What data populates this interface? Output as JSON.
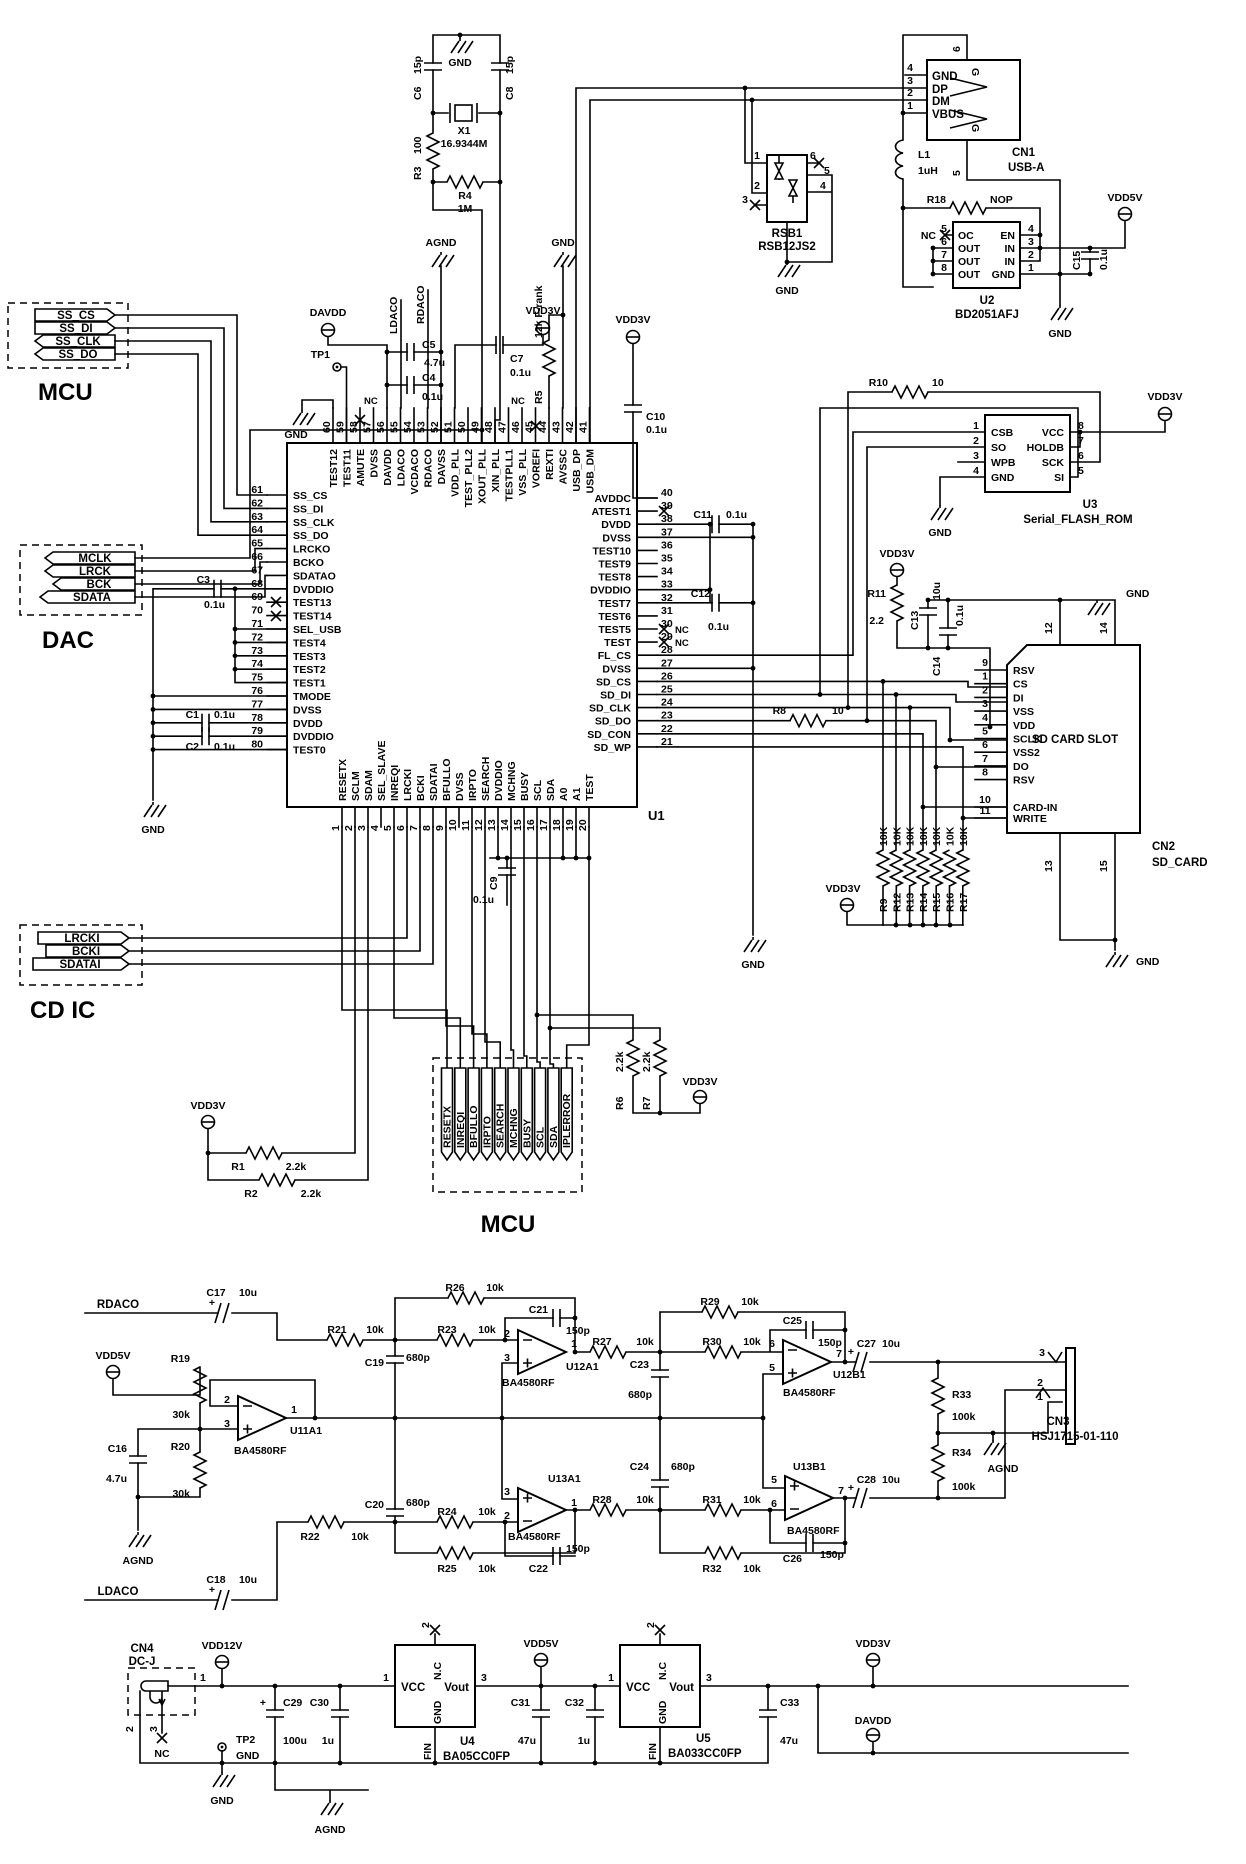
{
  "labels": {
    "gnd": "GND",
    "agnd": "AGND",
    "nc": "NC",
    "vdd3v": "VDD3V",
    "vdd5v": "VDD5V",
    "vdd12v": "VDD12V",
    "davdd": "DAVDD",
    "tp1": "TP1",
    "tp2": "TP2",
    "plus": "+"
  },
  "x1": {
    "ref": "X1",
    "v": "16.9344M"
  },
  "l1": {
    "ref": "L1",
    "v": "1uH"
  },
  "r": {
    "r1": {
      "ref": "R1",
      "v": "2.2k"
    },
    "r2": {
      "ref": "R2",
      "v": "2.2k"
    },
    "r3": {
      "ref": "R3",
      "v": "100"
    },
    "r4": {
      "ref": "R4",
      "v": "1M"
    },
    "r5": {
      "ref": "R5",
      "v": "12k F-rank"
    },
    "r6": {
      "ref": "R6",
      "v": "2.2k"
    },
    "r7": {
      "ref": "R7",
      "v": "2.2k"
    },
    "r8": {
      "ref": "R8",
      "v": "10"
    },
    "r10": {
      "ref": "R10",
      "v": "10"
    },
    "r11": {
      "ref": "R11",
      "v": "2.2"
    },
    "r18": {
      "ref": "R18",
      "v": "NOP"
    },
    "r19": {
      "ref": "R19",
      "v": "30k"
    },
    "r20": {
      "ref": "R20",
      "v": "30k"
    },
    "r21": {
      "ref": "R21",
      "v": "10k"
    },
    "r22": {
      "ref": "R22",
      "v": "10k"
    },
    "r23": {
      "ref": "R23",
      "v": "10k"
    },
    "r24": {
      "ref": "R24",
      "v": "10k"
    },
    "r25": {
      "ref": "R25",
      "v": "10k"
    },
    "r26": {
      "ref": "R26",
      "v": "10k"
    },
    "r27": {
      "ref": "R27",
      "v": "10k"
    },
    "r28": {
      "ref": "R28",
      "v": "10k"
    },
    "r29": {
      "ref": "R29",
      "v": "10k"
    },
    "r30": {
      "ref": "R30",
      "v": "10k"
    },
    "r31": {
      "ref": "R31",
      "v": "10k"
    },
    "r32": {
      "ref": "R32",
      "v": "10k"
    },
    "r33": {
      "ref": "R33",
      "v": "100k"
    },
    "r34": {
      "ref": "R34",
      "v": "100k"
    }
  },
  "c": {
    "c1": {
      "ref": "C1",
      "v": "0.1u"
    },
    "c2": {
      "ref": "C2",
      "v": "0.1u"
    },
    "c3": {
      "ref": "C3",
      "v": "0.1u"
    },
    "c4": {
      "ref": "C4",
      "v": "0.1u"
    },
    "c5": {
      "ref": "C5",
      "v": "4.7u"
    },
    "c6": {
      "ref": "C6",
      "v": "15p"
    },
    "c7": {
      "ref": "C7",
      "v": "0.1u"
    },
    "c8": {
      "ref": "C8",
      "v": "15p"
    },
    "c9": {
      "ref": "C9",
      "v": "0.1u"
    },
    "c10": {
      "ref": "C10",
      "v": "0.1u"
    },
    "c11": {
      "ref": "C11",
      "v": "0.1u"
    },
    "c12": {
      "ref": "C12",
      "v": "0.1u"
    },
    "c13": {
      "ref": "C13",
      "v": "10u"
    },
    "c14": {
      "ref": "C14",
      "v": "0.1u"
    },
    "c15": {
      "ref": "C15",
      "v": "0.1u"
    },
    "c16": {
      "ref": "C16",
      "v": "4.7u"
    },
    "c17": {
      "ref": "C17",
      "v": "10u"
    },
    "c18": {
      "ref": "C18",
      "v": "10u"
    },
    "c19": {
      "ref": "C19",
      "v": "680p"
    },
    "c20": {
      "ref": "C20",
      "v": "680p"
    },
    "c21": {
      "ref": "C21",
      "v": "150p"
    },
    "c22": {
      "ref": "C22",
      "v": "150p"
    },
    "c23": {
      "ref": "C23",
      "v": "680p"
    },
    "c24": {
      "ref": "C24",
      "v": "680p"
    },
    "c25": {
      "ref": "C25",
      "v": "150p"
    },
    "c26": {
      "ref": "C26",
      "v": "150p"
    },
    "c27": {
      "ref": "C27",
      "v": "10u"
    },
    "c28": {
      "ref": "C28",
      "v": "10u"
    },
    "c29": {
      "ref": "C29",
      "v": "100u"
    },
    "c30": {
      "ref": "C30",
      "v": "1u"
    },
    "c31": {
      "ref": "C31",
      "v": "47u"
    },
    "c32": {
      "ref": "C32",
      "v": "1u"
    },
    "c33": {
      "ref": "C33",
      "v": "47u"
    }
  },
  "u1": {
    "ref": "U1",
    "top": [
      [
        "60",
        "TEST12"
      ],
      [
        "59",
        "TEST11"
      ],
      [
        "58",
        "AMUTE"
      ],
      [
        "57",
        "DVSS"
      ],
      [
        "56",
        "DAVDD"
      ],
      [
        "55",
        "LDACO"
      ],
      [
        "54",
        "VCDACO"
      ],
      [
        "53",
        "RDACO"
      ],
      [
        "52",
        "DAVSS"
      ],
      [
        "51",
        "VDD_PLL"
      ],
      [
        "50",
        "TEST_PLL2"
      ],
      [
        "49",
        "XOUT_PLL"
      ],
      [
        "48",
        "XIN_PLL"
      ],
      [
        "47",
        "TESTPLL1"
      ],
      [
        "46",
        "VSS_PLL"
      ],
      [
        "45",
        "VOREFI"
      ],
      [
        "44",
        "REXTI"
      ],
      [
        "43",
        "AVSSC"
      ],
      [
        "42",
        "USB_DP"
      ],
      [
        "41",
        "USB_DM"
      ]
    ],
    "left": [
      [
        "61",
        "SS_CS"
      ],
      [
        "62",
        "SS_DI"
      ],
      [
        "63",
        "SS_CLK"
      ],
      [
        "64",
        "SS_DO"
      ],
      [
        "65",
        "LRCKO"
      ],
      [
        "66",
        "BCKO"
      ],
      [
        "67",
        "SDATAO"
      ],
      [
        "68",
        "DVDDIO"
      ],
      [
        "69",
        "TEST13"
      ],
      [
        "70",
        "TEST14"
      ],
      [
        "71",
        "SEL_USB"
      ],
      [
        "72",
        "TEST4"
      ],
      [
        "73",
        "TEST3"
      ],
      [
        "74",
        "TEST2"
      ],
      [
        "75",
        "TEST1"
      ],
      [
        "76",
        "TMODE"
      ],
      [
        "77",
        "DVSS"
      ],
      [
        "78",
        "DVDD"
      ],
      [
        "79",
        "DVDDIO"
      ],
      [
        "80",
        "TEST0"
      ]
    ],
    "right": [
      [
        "40",
        "AVDDC"
      ],
      [
        "39",
        "ATEST1"
      ],
      [
        "38",
        "DVDD"
      ],
      [
        "37",
        "DVSS"
      ],
      [
        "36",
        "TEST10"
      ],
      [
        "35",
        "TEST9"
      ],
      [
        "34",
        "TEST8"
      ],
      [
        "33",
        "DVDDIO"
      ],
      [
        "32",
        "TEST7"
      ],
      [
        "31",
        "TEST6"
      ],
      [
        "30",
        "TEST5"
      ],
      [
        "29",
        "TEST"
      ],
      [
        "28",
        "FL_CS"
      ],
      [
        "27",
        "DVSS"
      ],
      [
        "26",
        "SD_CS"
      ],
      [
        "25",
        "SD_DI"
      ],
      [
        "24",
        "SD_CLK"
      ],
      [
        "23",
        "SD_DO"
      ],
      [
        "22",
        "SD_CON"
      ],
      [
        "21",
        "SD_WP"
      ]
    ],
    "bottom": [
      [
        "1",
        "RESETX"
      ],
      [
        "2",
        "SCLM"
      ],
      [
        "3",
        "SDAM"
      ],
      [
        "4",
        "SEL_SLAVE"
      ],
      [
        "5",
        "INREQI"
      ],
      [
        "6",
        "LRCKI"
      ],
      [
        "7",
        "BCKI"
      ],
      [
        "8",
        "SDATAI"
      ],
      [
        "9",
        "BFULLO"
      ],
      [
        "10",
        "DVSS"
      ],
      [
        "11",
        "IRPTO"
      ],
      [
        "12",
        "SEARCH"
      ],
      [
        "13",
        "DVDDIO"
      ],
      [
        "14",
        "MCHNG"
      ],
      [
        "15",
        "BUSY"
      ],
      [
        "16",
        "SCL"
      ],
      [
        "17",
        "SDA"
      ],
      [
        "18",
        "A0"
      ],
      [
        "19",
        "A1"
      ],
      [
        "20",
        "TEST"
      ]
    ],
    "netlabels": {
      "ldaco": "LDACO",
      "rdaco": "RDACO"
    }
  },
  "cn1": {
    "ref": "CN1",
    "part": "USB-A",
    "p4": "4",
    "gnd": "GND",
    "p3": "3",
    "dp": "DP",
    "p2": "2",
    "dm": "DM",
    "p1": "1",
    "vbus": "VBUS",
    "p6": "6",
    "p5": "5",
    "g": "G"
  },
  "rsb1": {
    "ref": "RSB1",
    "part": "RSB12JS2",
    "p1": "1",
    "p2": "2",
    "p3": "3",
    "p4": "4",
    "p5": "5",
    "p6": "6"
  },
  "u2": {
    "ref": "U2",
    "part": "BD2051AFJ",
    "l": [
      [
        "5",
        "OC"
      ],
      [
        "6",
        "OUT"
      ],
      [
        "7",
        "OUT"
      ],
      [
        "8",
        "OUT"
      ]
    ],
    "rt": [
      [
        "4",
        "EN"
      ],
      [
        "3",
        "IN"
      ],
      [
        "2",
        "IN"
      ],
      [
        "1",
        "GND"
      ]
    ]
  },
  "u3": {
    "ref": "U3",
    "part": "Serial_FLASH_ROM",
    "l": [
      [
        "1",
        "CSB"
      ],
      [
        "2",
        "SO"
      ],
      [
        "3",
        "WPB"
      ],
      [
        "4",
        "GND"
      ]
    ],
    "rt": [
      [
        "8",
        "VCC"
      ],
      [
        "7",
        "HOLDB"
      ],
      [
        "6",
        "SCK"
      ],
      [
        "5",
        "SI"
      ]
    ]
  },
  "cn2": {
    "ref": "CN2",
    "part": "SD_CARD",
    "title": "SD CARD SLOT",
    "pins": [
      [
        "9",
        "RSV"
      ],
      [
        "1",
        "CS"
      ],
      [
        "2",
        "DI"
      ],
      [
        "3",
        "VSS"
      ],
      [
        "4",
        "VDD"
      ],
      [
        "5",
        "SCLK"
      ],
      [
        "6",
        "VSS2"
      ],
      [
        "7",
        "DO"
      ],
      [
        "8",
        "RSV"
      ]
    ],
    "pins2": [
      [
        "10",
        "CARD-IN"
      ],
      [
        "11",
        "WRITE"
      ]
    ],
    "t12": "12",
    "t14": "14",
    "b13": "13",
    "b15": "15"
  },
  "sd": {
    "pullups": [
      [
        "R9",
        "10K"
      ],
      [
        "R12",
        "10K"
      ],
      [
        "R13",
        "10K"
      ],
      [
        "R14",
        "10K"
      ],
      [
        "R15",
        "10K"
      ],
      [
        "R16",
        "10K"
      ],
      [
        "R17",
        "10K"
      ]
    ]
  },
  "conn": {
    "mcu_top": {
      "label": "MCU",
      "tags": [
        "SS_CS",
        "SS_DI",
        "SS_CLK",
        "SS_DO"
      ]
    },
    "dac": {
      "label": "DAC",
      "tags": [
        "MCLK",
        "LRCK",
        "BCK",
        "SDATA"
      ]
    },
    "cdic": {
      "label": "CD IC",
      "tags": [
        "LRCKI",
        "BCKI",
        "SDATAI"
      ]
    },
    "mcu_bottom": {
      "label": "MCU",
      "tags": [
        "RESETX",
        "INREQI",
        "BFULLO",
        "IRPTO",
        "SEARCH",
        "MCHNG",
        "BUSY",
        "SCL",
        "SDA",
        "IPLERROR"
      ]
    }
  },
  "opamps": {
    "u11a1": {
      "ref": "U11A1",
      "part": "BA4580RF",
      "p1": "2",
      "p2": "3",
      "po": "1"
    },
    "u12a1": {
      "ref": "U12A1",
      "part": "BA4580RF",
      "p1": "2",
      "p2": "3",
      "po": "1"
    },
    "u12b1": {
      "ref": "U12B1",
      "part": "BA4580RF",
      "p1": "6",
      "p2": "5",
      "po": "7"
    },
    "u13a1": {
      "ref": "U13A1",
      "part": "BA4580RF",
      "p1": "3",
      "p2": "2",
      "po": "1"
    },
    "u13b1": {
      "ref": "U13B1",
      "part": "BA4580RF",
      "p1": "5",
      "p2": "6",
      "po": "7"
    }
  },
  "audio": {
    "rdaco": "RDACO",
    "ldaco": "LDACO"
  },
  "cn3": {
    "ref": "CN3",
    "part": "HSJ1715-01-110",
    "p3": "3",
    "p2": "2",
    "p1": "1"
  },
  "cn4": {
    "ref": "CN4",
    "part": "DC-J",
    "p1": "1",
    "p2": "2",
    "p3": "3"
  },
  "u4": {
    "ref": "U4",
    "part": "BA05CC0FP",
    "vcc": "VCC",
    "vout": "Vout",
    "nc": "N.C",
    "gnd": "GND",
    "fin": "FIN",
    "n1": "1",
    "n3": "3",
    "n2": "2"
  },
  "u5": {
    "ref": "U5",
    "part": "BA033CC0FP",
    "vcc": "VCC",
    "vout": "Vout",
    "nc": "N.C",
    "gnd": "GND",
    "fin": "FIN",
    "n1": "1",
    "n3": "3",
    "n2": "2"
  }
}
